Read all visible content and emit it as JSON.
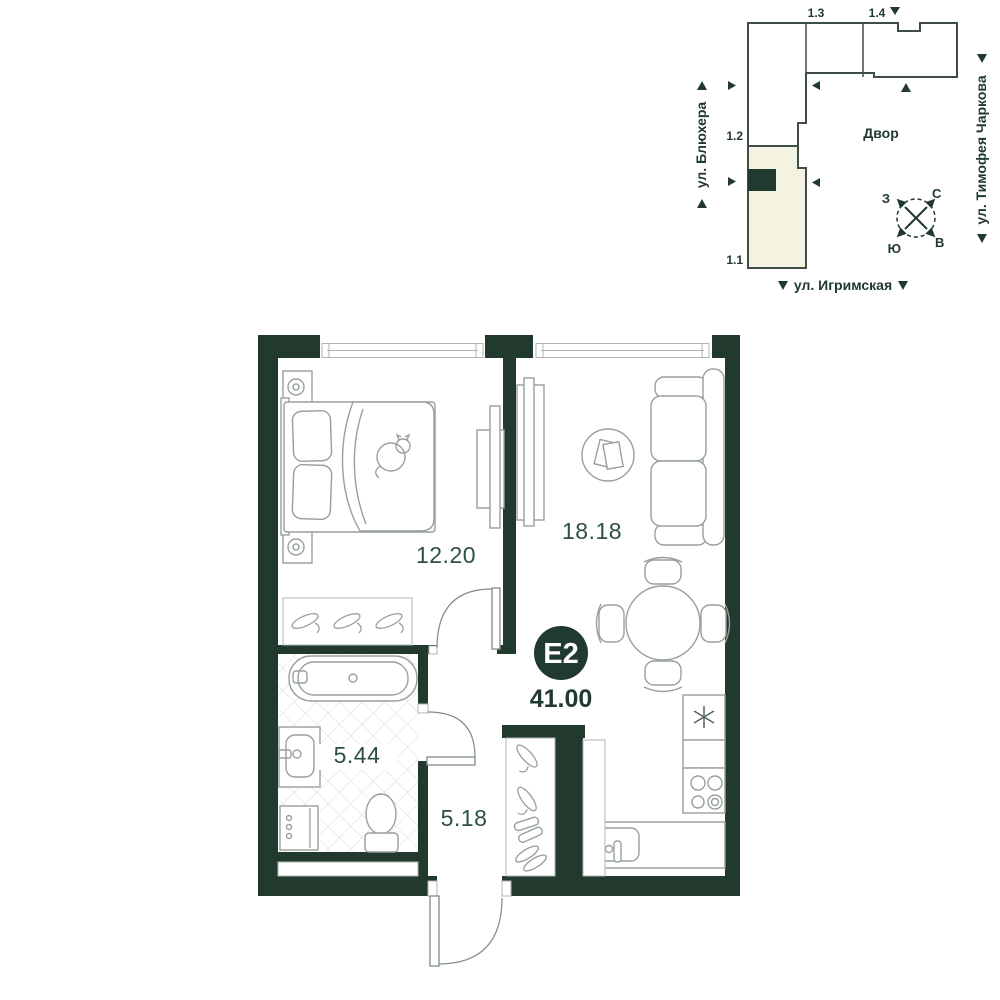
{
  "floor_plan": {
    "badge_label": "Е2",
    "total_area": "41.00",
    "rooms": {
      "bedroom": {
        "area": "12.20"
      },
      "living": {
        "area": "18.18"
      },
      "bathroom": {
        "area": "5.44"
      },
      "hallway": {
        "area": "5.18"
      }
    },
    "colors": {
      "wall": "#22392E",
      "area_label": "#2E5040",
      "furniture_outline": "#97A19A"
    }
  },
  "site_plan": {
    "courtyard": "Двор",
    "sections": {
      "s11": "1.1",
      "s12": "1.2",
      "s13": "1.3",
      "s14": "1.4"
    },
    "streets": {
      "left": "ул. Блюхера",
      "right": "ул. Тимофея Чаркова",
      "bottom": "ул. Игримская"
    },
    "compass": {
      "west": "З",
      "north": "С",
      "south": "Ю",
      "east": "В"
    },
    "highlight_color": "#F4F3E1",
    "marker_color": "#213A2F"
  }
}
